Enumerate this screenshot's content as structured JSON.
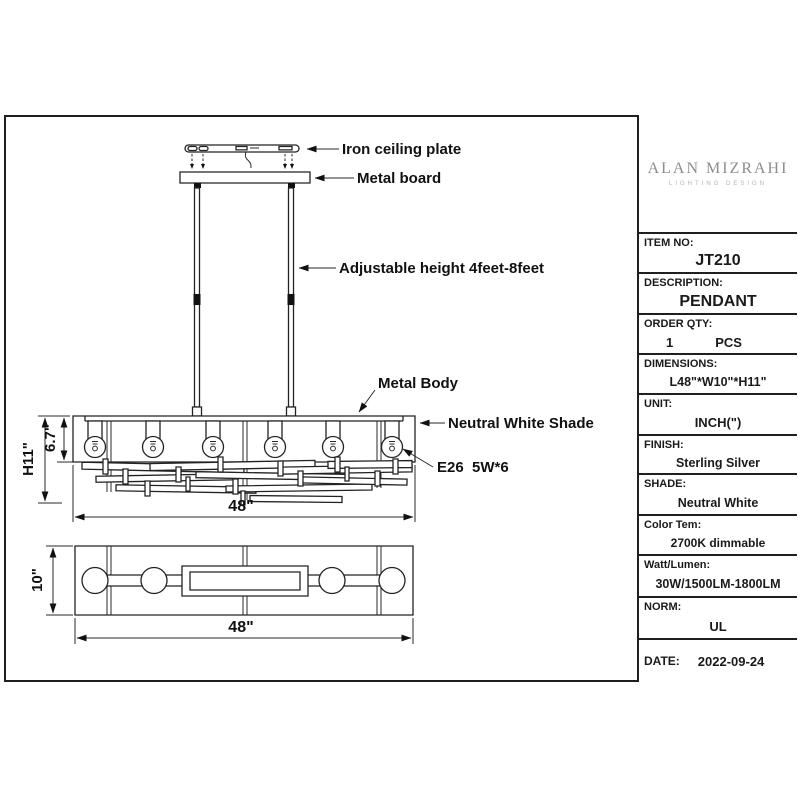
{
  "drawing": {
    "labels": {
      "iron_ceiling_plate": "Iron ceiling plate",
      "metal_board": "Metal board",
      "adjustable_height": "Adjustable height 4feet-8feet",
      "metal_body": "Metal Body",
      "neutral_white_shade": "Neutral White Shade",
      "lamp_spec": "E26  5W*6"
    },
    "dimensions": {
      "height_overall": "H11\"",
      "shade_height": "6.7\"",
      "width_front": "48\"",
      "depth": "10\"",
      "width_bottom": "48\""
    }
  },
  "title_block": {
    "logo": {
      "name": "ALAN MIZRAHI",
      "tagline": "LIGHTING DESIGN"
    },
    "rows": [
      {
        "label": "ITEM NO:",
        "value": "JT210"
      },
      {
        "label": "DESCRIPTION:",
        "value": "PENDANT"
      },
      {
        "label": "ORDER QTY:",
        "qty": "1",
        "unit": "PCS"
      },
      {
        "label": "DIMENSIONS:",
        "value": "L48\"*W10\"*H11\""
      },
      {
        "label": "UNIT:",
        "value": "INCH(\")"
      },
      {
        "label": "FINISH:",
        "value": "Sterling Silver"
      },
      {
        "label": "SHADE:",
        "value": "Neutral White"
      },
      {
        "label": "Color Tem:",
        "value": "2700K dimmable"
      },
      {
        "label": "Watt/Lumen:",
        "value": "30W/1500LM-1800LM"
      },
      {
        "label": "NORM:",
        "value": "UL"
      }
    ],
    "date": {
      "label": "DATE:",
      "value": "2022-09-24"
    }
  },
  "colors": {
    "line": "#232323",
    "frame": "#1f1f1f",
    "logo_gray": "#8d8d8d"
  }
}
